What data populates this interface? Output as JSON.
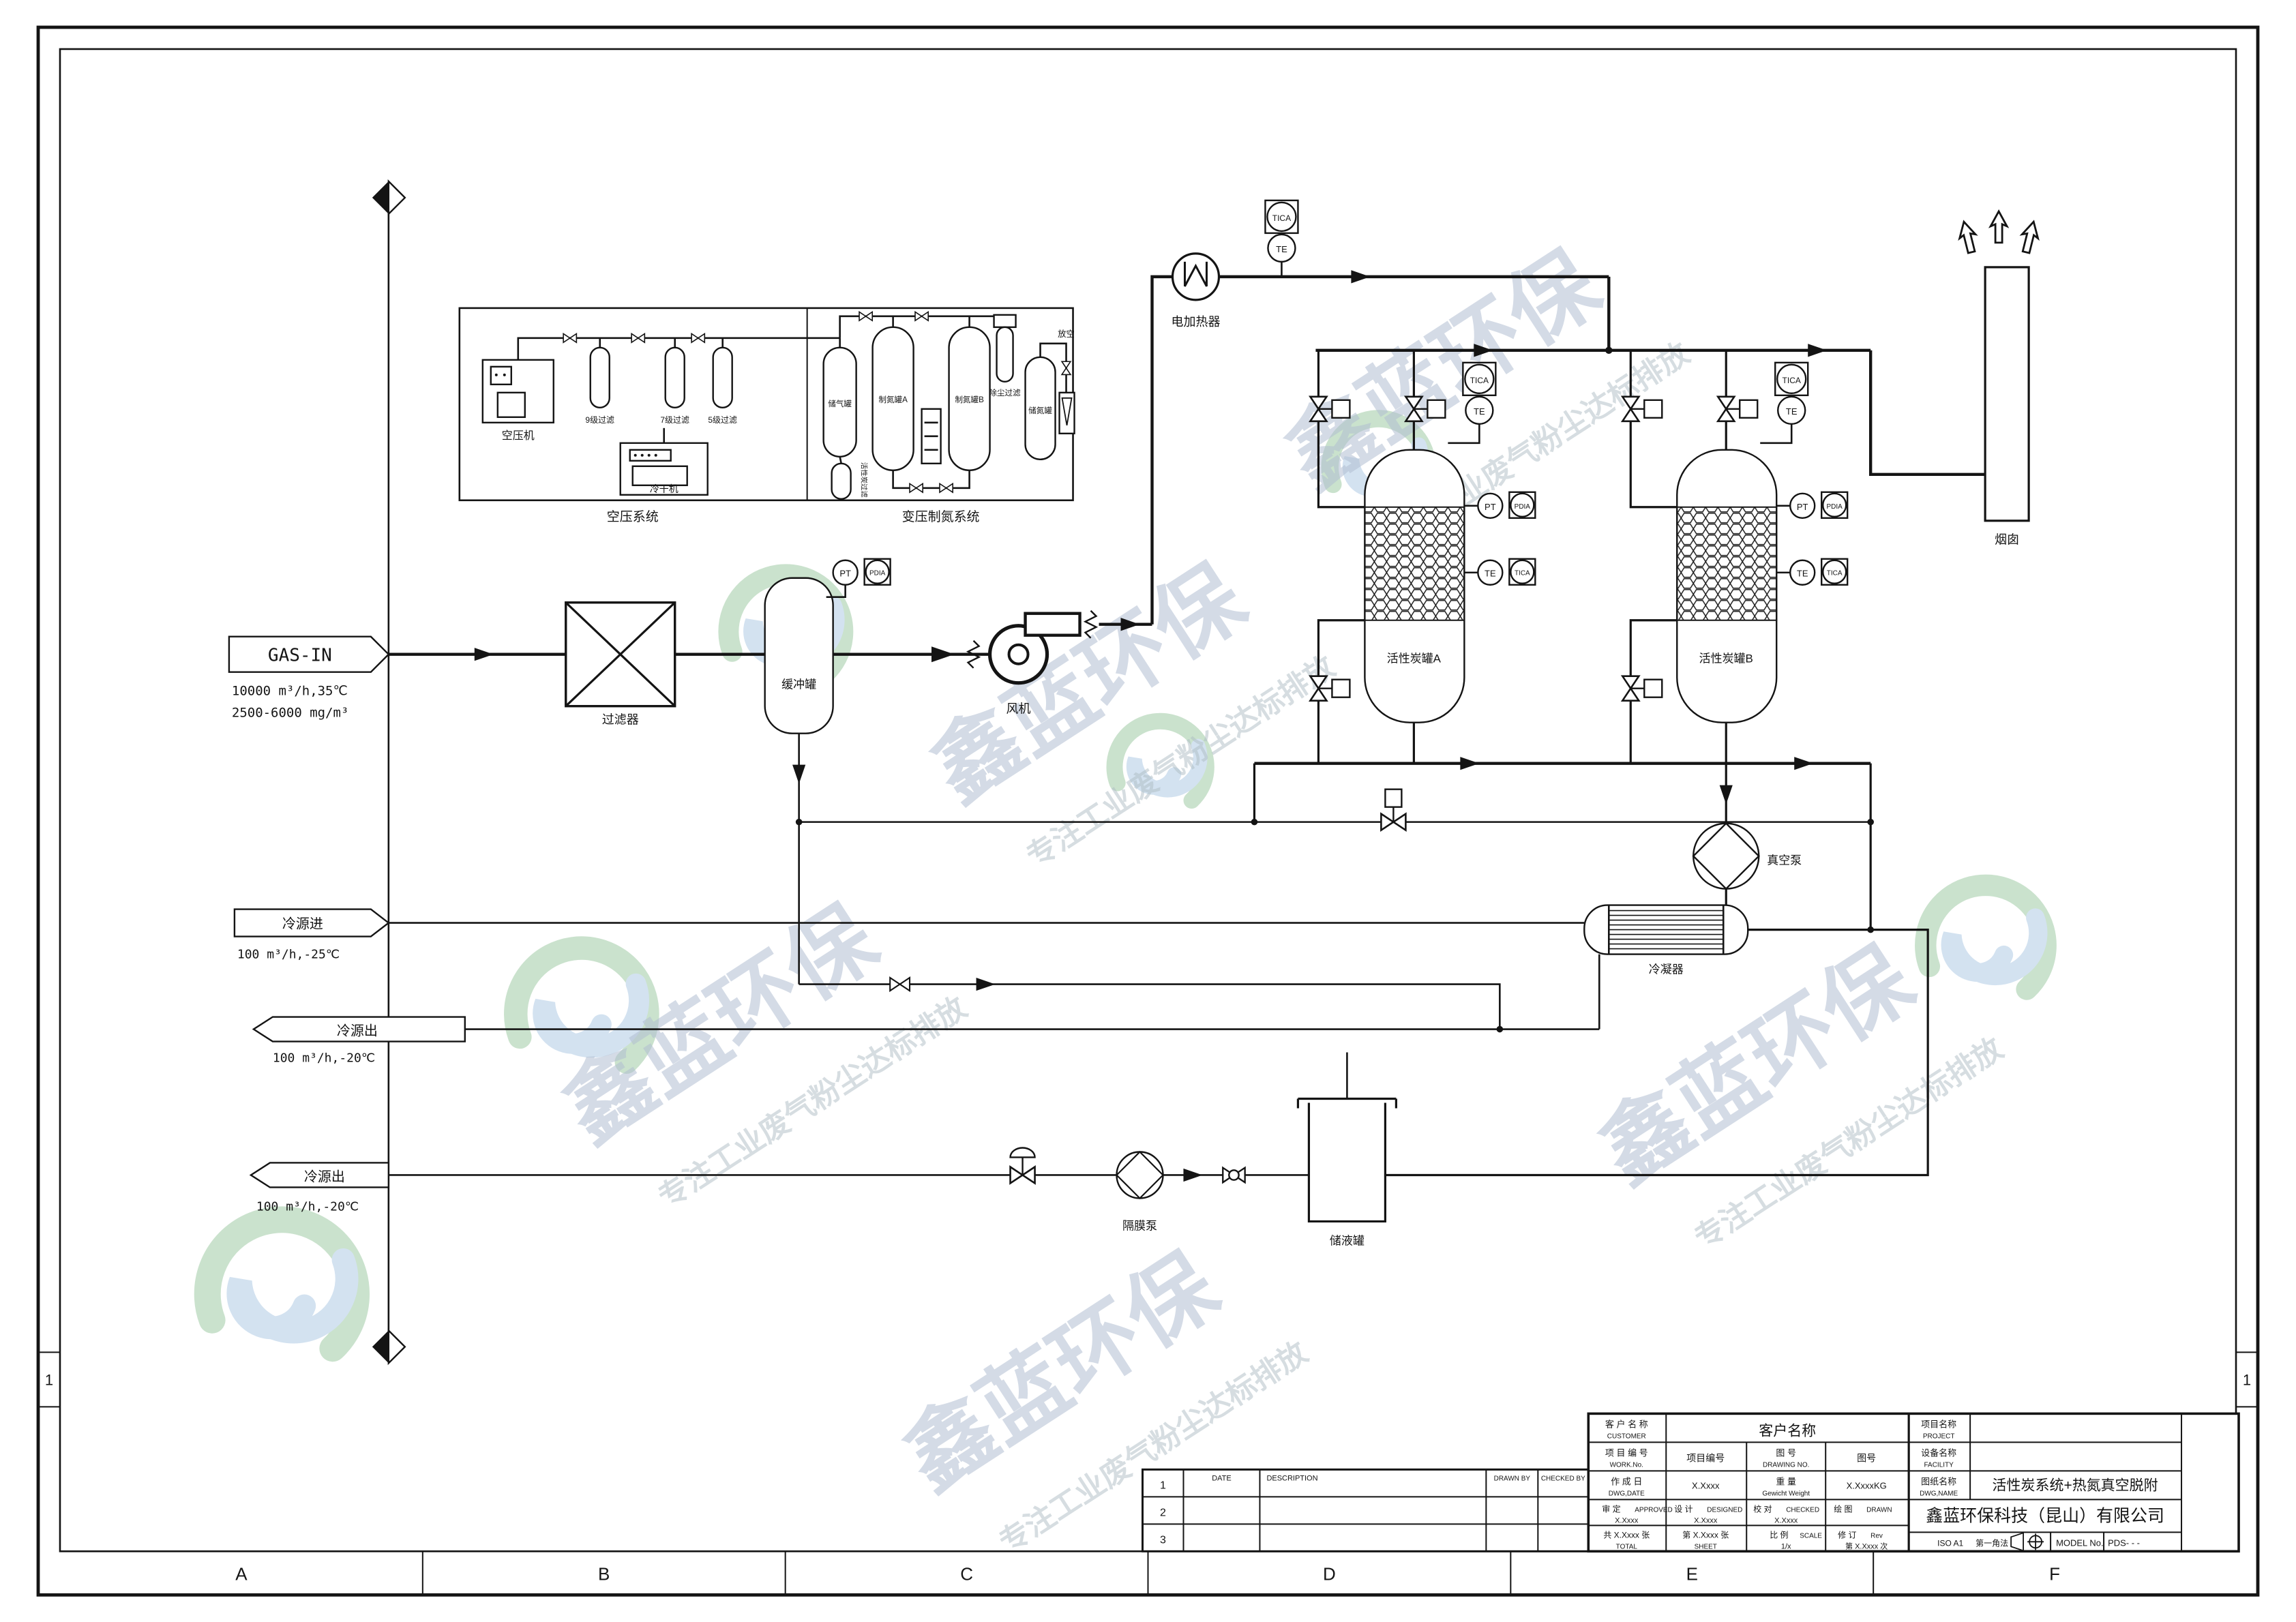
{
  "drawing": {
    "watermark": {
      "brand": "鑫蓝环保",
      "slogan": "专注工业废气粉尘达标排放"
    },
    "zones": {
      "columns": [
        "A",
        "B",
        "C",
        "D",
        "E",
        "F"
      ],
      "row_label": "1"
    },
    "streams": {
      "gas_in": {
        "tag": "GAS-IN",
        "line1": "10000 m³/h,35℃",
        "line2": "2500-6000 mg/m³"
      },
      "cold_in": {
        "tag": "冷源进",
        "line1": "100 m³/h,-25℃"
      },
      "cold_out_upper": {
        "tag": "冷源出",
        "line1": "100 m³/h,-20℃"
      },
      "cold_out_lower": {
        "tag": "冷源出",
        "line1": "100 m³/h,-20℃"
      }
    },
    "air_system": {
      "caption": "空压系统",
      "compressor": "空压机",
      "dryer": "冷干机",
      "filter_9": "9级过滤",
      "filter_7": "7级过滤",
      "filter_5": "5级过滤"
    },
    "nitrogen_system": {
      "caption": "变压制氮系统",
      "air_tank": "储气罐",
      "n2_tank_a": "制氮罐A",
      "n2_tank_b": "制氮罐B",
      "carbon_filter": "活性炭过滤",
      "dust_filter": "除尘过滤",
      "n2_storage": "储氮罐",
      "vent": "放空"
    },
    "equipment": {
      "filter": "过滤器",
      "buffer_tank": "缓冲罐",
      "fan": "风机",
      "heater": "电加热器",
      "carbon_tank_a": "活性炭罐A",
      "carbon_tank_b": "活性炭罐B",
      "stack": "烟囱",
      "vacuum_pump": "真空泵",
      "condenser": "冷凝器",
      "diaphragm_pump": "隔膜泵",
      "storage_tank": "储液罐"
    },
    "instruments": {
      "tica": "TICA",
      "te": "TE",
      "pt": "PT",
      "pdia": "PDIA"
    }
  },
  "revision_table": {
    "row1": "1",
    "row2": "2",
    "row3": "3",
    "date": "DATE",
    "description": "DESCRIPTION",
    "drawn_by": "DRAWN BY",
    "checked_by": "CHECKED BY"
  },
  "title_block": {
    "customer_cn": "客 户 名 称",
    "customer_en": "CUSTOMER",
    "customer_value": "客户名称",
    "work_no_cn": "项 目 编 号",
    "work_no_en": "WORK.No.",
    "work_no_value": "项目编号",
    "drawing_no_cn": "图 号",
    "drawing_no_en": "DRAWING NO.",
    "drawing_no_value": "图号",
    "date_cn": "作 成 日",
    "date_en": "DWG,DATE",
    "date_value": "X.Xxxx",
    "weight_cn": "重 量",
    "weight_en": "Gewicht Weight",
    "weight_value": "X.XxxxKG",
    "approved_cn": "审 定",
    "approved_en": "APPROVED",
    "approved_value": "X.Xxxx",
    "designed_cn": "设 计",
    "designed_en": "DESIGNED",
    "designed_value": "X.Xxxx",
    "checked_cn": "校 对",
    "checked_en": "CHECKED",
    "checked_value": "X.Xxxx",
    "drawn_cn": "绘 图",
    "drawn_en": "DRAWN",
    "total_cn": "共 X.Xxxx 张",
    "total_en": "TOTAL",
    "sheet_cn": "第 X.Xxxx 张",
    "sheet_en": "SHEET",
    "scale_cn": "比 例",
    "scale_en": "SCALE",
    "scale_value": "1/x",
    "rev_cn": "修 订",
    "rev_en": "Rev",
    "rev_value": "第 X.Xxxx 次",
    "project_cn": "项目名称",
    "project_en": "PROJECT",
    "facility_cn": "设备名称",
    "facility_en": "FACILITY",
    "dwg_name_cn": "图纸名称",
    "dwg_name_en": "DWG,NAME",
    "dwg_name_value": "活性炭系统+热氮真空脱附",
    "company": "鑫蓝环保科技（昆山）有限公司",
    "paper": "ISO A1",
    "projection": "第一角法",
    "model_label": "MODEL No.",
    "model_value": "PDS-  -  -"
  }
}
